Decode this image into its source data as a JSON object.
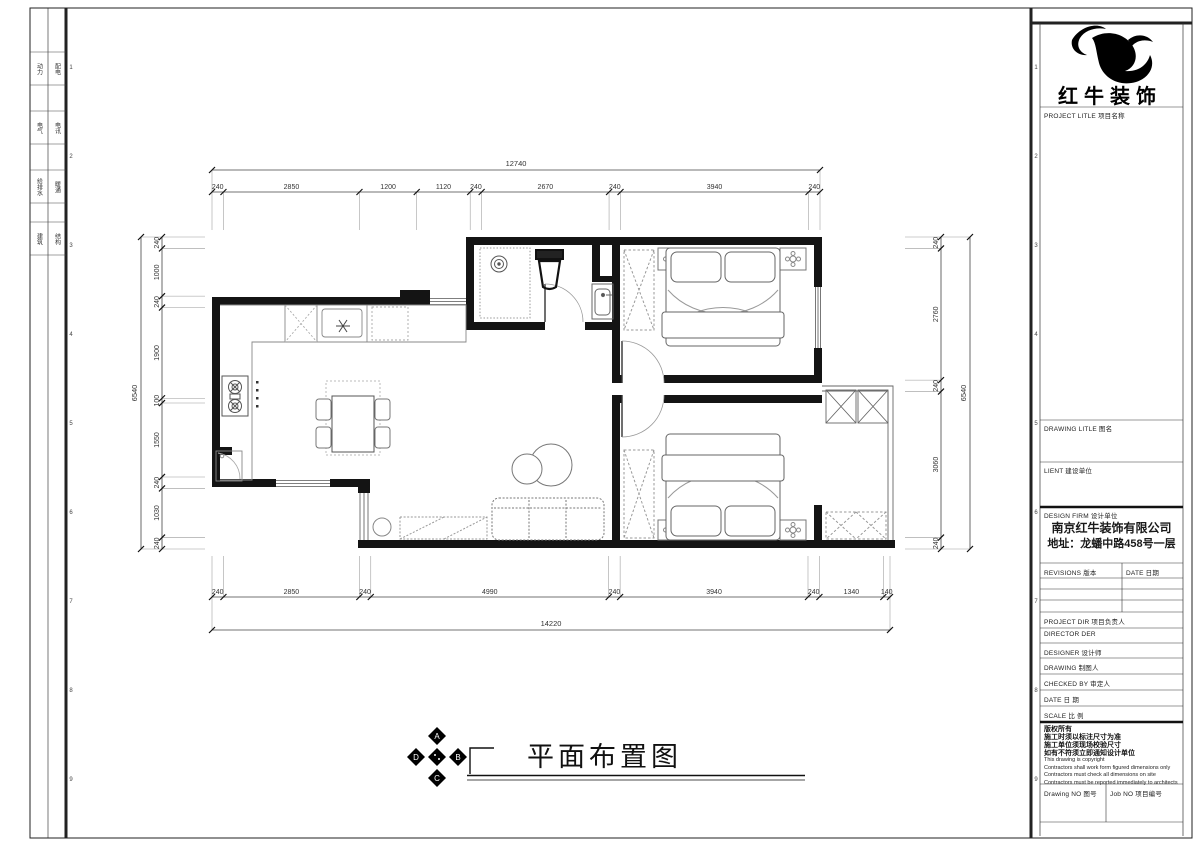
{
  "sheet": {
    "disciplines": [
      [
        "动力",
        "配电"
      ],
      [
        "电气",
        "电讯"
      ],
      [
        "给排水",
        "暖通"
      ],
      [
        "建筑",
        "结构"
      ]
    ],
    "grid_numbers": [
      "1",
      "2",
      "3",
      "4",
      "5",
      "6",
      "7",
      "8",
      "9"
    ]
  },
  "title_block": {
    "brand": "红牛装饰",
    "project_title_label": "PROJECT LITLE  项目名称",
    "drawing_title_label": "DRAWING LITLE  图名",
    "client_label": "LIENT  建设单位",
    "design_firm_label": "DESIGN FIRM  设计单位",
    "firm_name": "南京红牛装饰有限公司",
    "firm_address": "地址：龙蟠中路458号一层",
    "revisions_label": "REVISIONS  版本",
    "revision_date_label": "DATE  日期",
    "project_dir_label": "PROJECT DIR    项目负责人",
    "director_label": "DIRECTOR DER",
    "designer_label": "DESIGNER       设计师",
    "drawing_by_label": "DRAWING        制图人",
    "checked_label": "CHECKED BY     审定人",
    "date_label": "DATE           日  期",
    "scale_label": "SCALE          比  例",
    "notes_cn": [
      "版权所有",
      "施工时须以标注尺寸为准",
      "施工单位须现场校验尺寸",
      "如有不符须立即通知设计单位"
    ],
    "notes_en": [
      "This drawing is copyright",
      "Contractors shall work form figured dimensions only",
      "Contractors must check all dimensions on site",
      "Contractors must be reported immediately to architects"
    ],
    "drawing_no_label": "Drawing NO  图号",
    "job_no_label": "Job NO  项目编号"
  },
  "drawing": {
    "title": "平面布置图",
    "compass_letters": [
      "A",
      "B",
      "C",
      "D"
    ],
    "dimensions": {
      "top": {
        "overall": "12740",
        "segments": [
          "240",
          "2850",
          "1200",
          "1120",
          "240",
          "2670",
          "240",
          "3940",
          "240"
        ]
      },
      "bottom": {
        "overall": "14220",
        "segments": [
          "240",
          "2850",
          "240",
          "4990",
          "240",
          "3940",
          "240",
          "1340",
          "140"
        ]
      },
      "left": {
        "overall": "6540",
        "segments": [
          "240",
          "1000",
          "240",
          "1900",
          "100",
          "1550",
          "240",
          "1030",
          "240"
        ]
      },
      "right": {
        "overall": "6540",
        "segments": [
          "240",
          "2760",
          "240",
          "3060",
          "240"
        ]
      }
    }
  }
}
